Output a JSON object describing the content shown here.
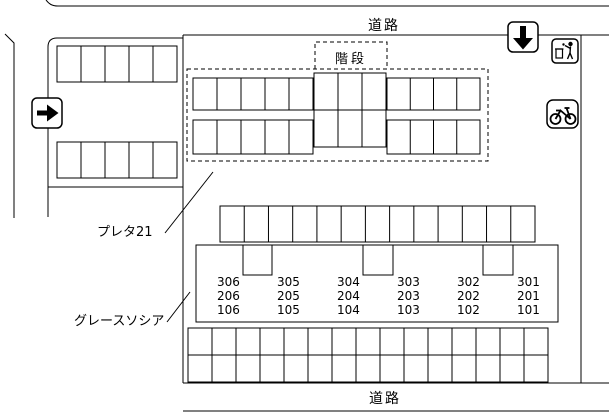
{
  "page": {
    "background": "#ffffff",
    "line_color": "#000000",
    "description": "site map of parking lot"
  },
  "labels": {
    "road_top": "道路",
    "road_bottom": "道路",
    "stairs": "階段",
    "building_preta": "プレタ21",
    "building_grace": "グレースソシア"
  },
  "icons": {
    "arrow_right": "right-arrow-sign",
    "arrow_down": "down-arrow-sign",
    "garbage": "garbage-station-sign",
    "bicycle": "bicycle-parking-sign"
  },
  "units": {
    "rows": [
      [
        "306",
        "305",
        "304",
        "303",
        "302",
        "301"
      ],
      [
        "206",
        "205",
        "204",
        "203",
        "202",
        "201"
      ],
      [
        "106",
        "105",
        "104",
        "103",
        "102",
        "101"
      ]
    ]
  },
  "parking": {
    "left_lot_rows": [
      5,
      5
    ],
    "preta_left_rows": [
      5,
      5
    ],
    "preta_center_rows": [
      3,
      3
    ],
    "preta_right_rows": [
      4,
      4
    ],
    "middle_row_spaces": 13,
    "bottom_lot_rows": [
      15,
      15
    ]
  }
}
